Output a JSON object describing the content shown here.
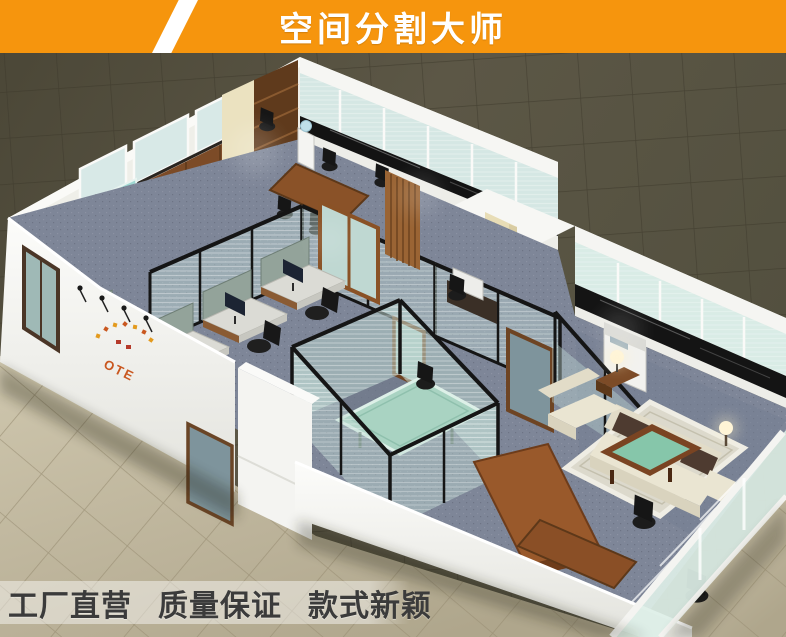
{
  "banner": {
    "title": "空间分割大师",
    "bg_color": "#F6950D",
    "stripe_color": "#FFFFFF",
    "text_color": "#FFFFFF"
  },
  "footer": {
    "slogans": [
      "工厂直营",
      "质量保证",
      "款式新颖"
    ],
    "text_color": "#3B3B3B",
    "band_color": "rgba(255,255,255,0.45)"
  },
  "scene": {
    "description": "isometric 3D render of an office interior divided by glass partitions",
    "logo_text": "OTE",
    "logo_color": "#C9571F",
    "rooms": [
      "reception",
      "open-office",
      "conference-room",
      "glass-meeting-room",
      "copier-area",
      "executive-lounge"
    ],
    "palette": {
      "floor_dark": "#56513F",
      "floor_beige": "#BCB39A",
      "wall_white": "#F3F3F0",
      "window_glass": "#D5E7E4",
      "partition_frame": "#151515",
      "wood": "#7C4B27",
      "carpet": "#7E8698",
      "marble_band": "#131313",
      "sofa_cream": "#E9E4D1",
      "cushion_brown": "#4E3B30",
      "table_glass_green": "#86C6AA"
    }
  }
}
